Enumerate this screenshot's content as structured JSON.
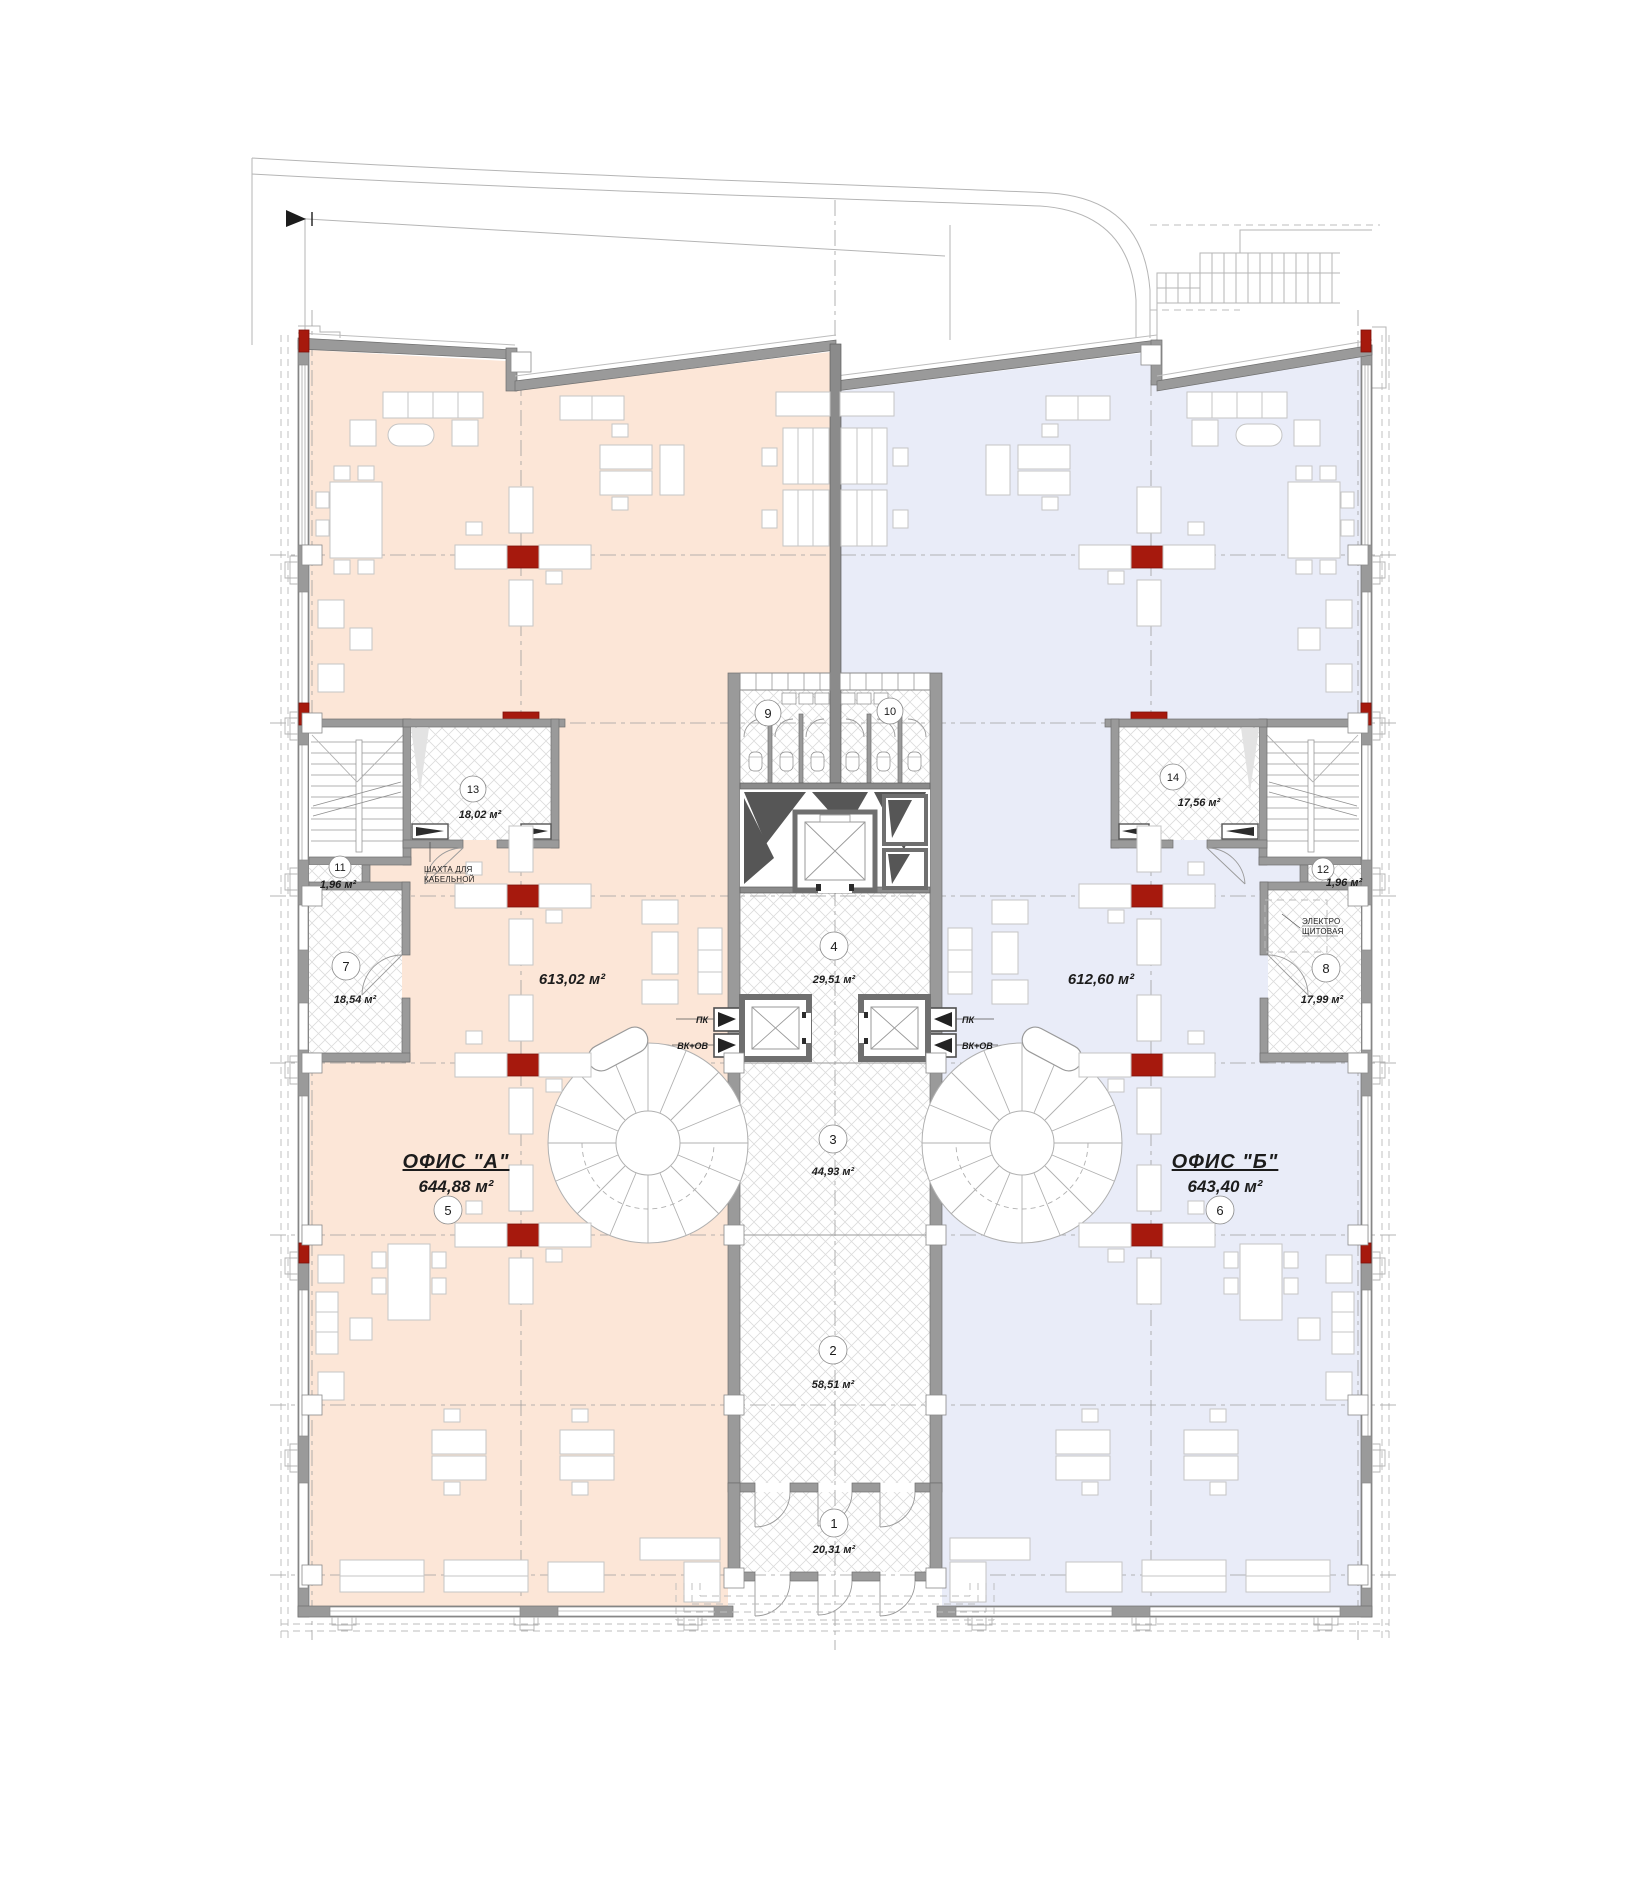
{
  "document": {
    "kind": "office-floor-plan"
  },
  "offices": [
    {
      "name": "ОФИС \"А\"",
      "area": "644,88 м²",
      "open_space_area": "613,02 м²",
      "badge": "5"
    },
    {
      "name": "ОФИС \"Б\"",
      "area": "643,40 м²",
      "open_space_area": "612,60 м²",
      "badge": "6"
    }
  ],
  "rooms": [
    {
      "n": "1",
      "area": "20,31 м²"
    },
    {
      "n": "2",
      "area": "58,51 м²"
    },
    {
      "n": "3",
      "area": "44,93 м²"
    },
    {
      "n": "4",
      "area": "29,51 м²"
    },
    {
      "n": "5",
      "area": ""
    },
    {
      "n": "6",
      "area": ""
    },
    {
      "n": "7",
      "area": "18,54 м²"
    },
    {
      "n": "8",
      "area": "17,99 м²"
    },
    {
      "n": "9",
      "area": ""
    },
    {
      "n": "10",
      "area": ""
    },
    {
      "n": "11",
      "area": "1,96 м²"
    },
    {
      "n": "12",
      "area": "1,96 м²"
    },
    {
      "n": "13",
      "area": "18,02 м²"
    },
    {
      "n": "14",
      "area": "17,56 м²"
    }
  ],
  "shafts": {
    "pk": "ПК",
    "vk_ov": "ВК+ОВ"
  },
  "notes": {
    "cable_shaft_line1": "ШАХТА ДЛЯ",
    "cable_shaft_line2": "КАБЕЛЬНОЙ",
    "electrical_line1": "ЭЛЕКТРО",
    "electrical_line2": "ЩИТОВАЯ"
  },
  "colors": {
    "office_a": "#fce6d7",
    "office_b": "#e9ecf8",
    "column": "#a6190d",
    "wall": "#9a9a9a"
  }
}
